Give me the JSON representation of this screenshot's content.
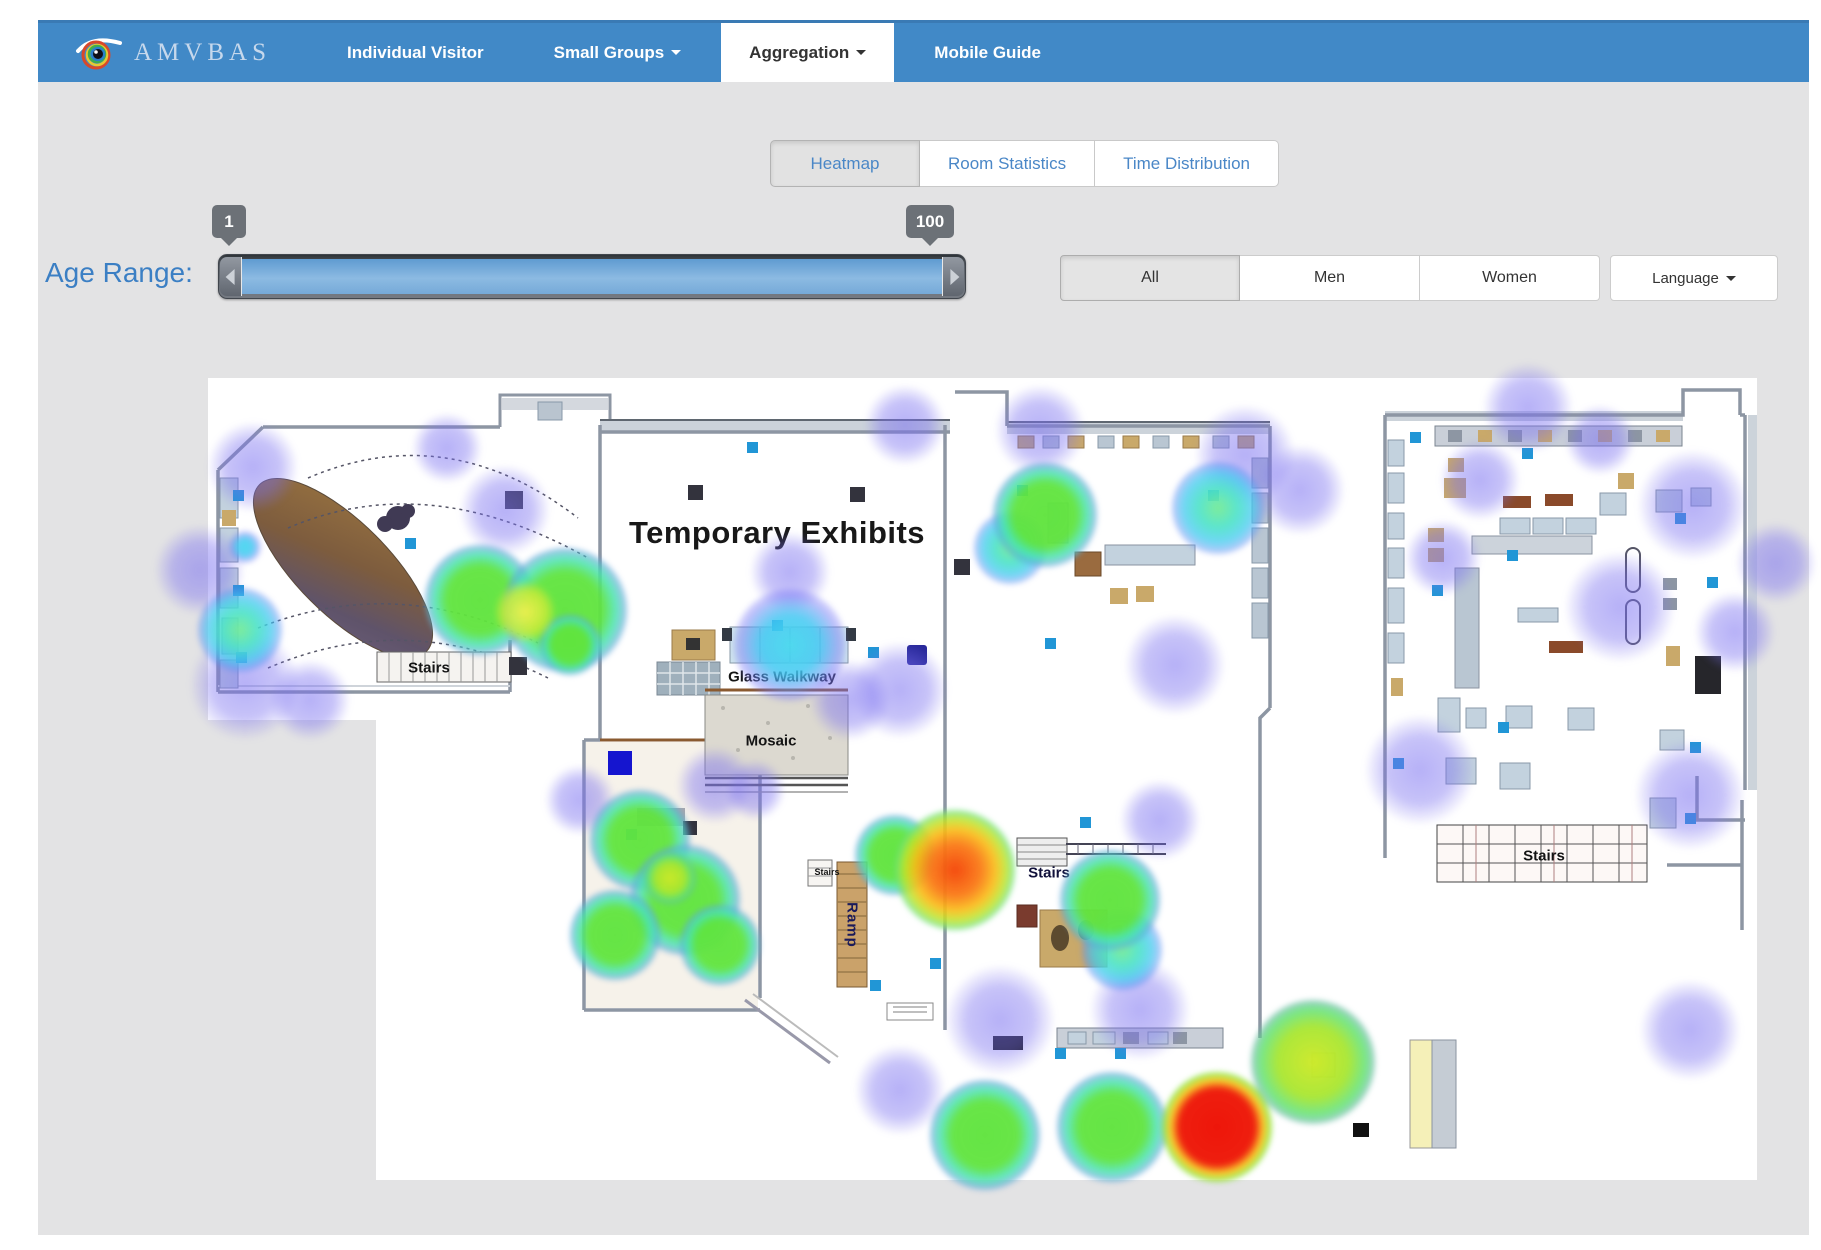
{
  "navbar": {
    "brand": "AMVBAS",
    "items": [
      {
        "label": "Individual Visitor",
        "active": false,
        "dropdown": false
      },
      {
        "label": "Small Groups",
        "active": false,
        "dropdown": true
      },
      {
        "label": "Aggregation",
        "active": true,
        "dropdown": true
      },
      {
        "label": "Mobile Guide",
        "active": false,
        "dropdown": false
      }
    ]
  },
  "view_tabs": [
    {
      "label": "Heatmap",
      "active": true
    },
    {
      "label": "Room Statistics",
      "active": false
    },
    {
      "label": "Time Distribution",
      "active": false
    }
  ],
  "filters": {
    "age_range": {
      "label": "Age Range:",
      "min": "1",
      "max": "100"
    },
    "buttons": [
      {
        "label": "All",
        "active": true
      },
      {
        "label": "Men",
        "active": false
      },
      {
        "label": "Women",
        "active": false
      },
      {
        "label": "Language",
        "active": false,
        "dropdown": true
      }
    ]
  },
  "colors": {
    "navbar_blue": "#4189c7",
    "page_gray": "#e3e3e4",
    "link_blue": "#4a87c7",
    "age_label_blue": "#3b7fc4",
    "heat_scale": {
      "low": "#7a70f0",
      "mid_low": "#48d8ee",
      "mid": "#60e43e",
      "mid_high": "#cde928",
      "high": "#fa7a16",
      "max": "#ee160a"
    }
  },
  "map": {
    "labels": [
      {
        "id": "temporary-exhibits",
        "text": "Temporary Exhibits",
        "x": 569,
        "y": 155,
        "cls": "ml-title"
      },
      {
        "id": "glass-walkway",
        "text": "Glass Walkway",
        "x": 574,
        "y": 299,
        "cls": "ml-small"
      },
      {
        "id": "mosaic",
        "text": "Mosaic",
        "x": 563,
        "y": 363,
        "cls": "ml-small"
      },
      {
        "id": "stairs-left",
        "text": "Stairs",
        "x": 221,
        "y": 290,
        "cls": "ml-small"
      },
      {
        "id": "stairs-center",
        "text": "Stairs",
        "x": 841,
        "y": 495,
        "cls": "ml-small ml-navy"
      },
      {
        "id": "stairs-right",
        "text": "Stairs",
        "x": 1336,
        "y": 478,
        "cls": "ml-small"
      },
      {
        "id": "ramp",
        "text": "Ramp",
        "x": 644,
        "y": 547,
        "cls": "ml-small ml-ramp"
      },
      {
        "id": "stairs-small",
        "text": "Stairs",
        "x": 619,
        "y": 494,
        "cls": "ml-tiny"
      }
    ],
    "heat_points": [
      {
        "x": 45,
        "y": 89,
        "r": 45,
        "c": "purple"
      },
      {
        "x": -8,
        "y": 192,
        "r": 45,
        "c": "purple"
      },
      {
        "x": 37,
        "y": 307,
        "r": 55,
        "c": "purple"
      },
      {
        "x": 102,
        "y": 322,
        "r": 40,
        "c": "purple"
      },
      {
        "x": 239,
        "y": 70,
        "r": 35,
        "c": "purple"
      },
      {
        "x": 297,
        "y": 132,
        "r": 45,
        "c": "purple"
      },
      {
        "x": 582,
        "y": 194,
        "r": 40,
        "c": "purple"
      },
      {
        "x": 642,
        "y": 322,
        "r": 40,
        "c": "purple"
      },
      {
        "x": 507,
        "y": 407,
        "r": 38,
        "c": "purple"
      },
      {
        "x": 372,
        "y": 422,
        "r": 35,
        "c": "purple"
      },
      {
        "x": 547,
        "y": 412,
        "r": 30,
        "c": "purple"
      },
      {
        "x": 697,
        "y": 47,
        "r": 40,
        "c": "purple"
      },
      {
        "x": 832,
        "y": 52,
        "r": 45,
        "c": "purple"
      },
      {
        "x": 1037,
        "y": 77,
        "r": 50,
        "c": "purple"
      },
      {
        "x": 1092,
        "y": 112,
        "r": 45,
        "c": "purple"
      },
      {
        "x": 967,
        "y": 287,
        "r": 50,
        "c": "purple"
      },
      {
        "x": 692,
        "y": 312,
        "r": 48,
        "c": "purple"
      },
      {
        "x": 952,
        "y": 442,
        "r": 40,
        "c": "purple"
      },
      {
        "x": 792,
        "y": 642,
        "r": 55,
        "c": "purple"
      },
      {
        "x": 932,
        "y": 632,
        "r": 50,
        "c": "purple"
      },
      {
        "x": 692,
        "y": 712,
        "r": 45,
        "c": "purple"
      },
      {
        "x": 1320,
        "y": 30,
        "r": 45,
        "c": "purple"
      },
      {
        "x": 1485,
        "y": 127,
        "r": 55,
        "c": "purple"
      },
      {
        "x": 1568,
        "y": 185,
        "r": 40,
        "c": "purple"
      },
      {
        "x": 1235,
        "y": 180,
        "r": 38,
        "c": "purple"
      },
      {
        "x": 1412,
        "y": 229,
        "r": 55,
        "c": "purple"
      },
      {
        "x": 1527,
        "y": 254,
        "r": 40,
        "c": "purple"
      },
      {
        "x": 1212,
        "y": 392,
        "r": 55,
        "c": "purple"
      },
      {
        "x": 1482,
        "y": 417,
        "r": 55,
        "c": "purple"
      },
      {
        "x": 1272,
        "y": 102,
        "r": 40,
        "c": "purple"
      },
      {
        "x": 1392,
        "y": 62,
        "r": 35,
        "c": "purple"
      },
      {
        "x": 1482,
        "y": 652,
        "r": 50,
        "c": "purple"
      },
      {
        "x": 37,
        "y": 169,
        "r": 16,
        "c": "cyan"
      },
      {
        "x": 582,
        "y": 267,
        "r": 56,
        "c": "cyan"
      },
      {
        "x": 32,
        "y": 252,
        "r": 42,
        "c": "teal"
      },
      {
        "x": 802,
        "y": 170,
        "r": 36,
        "c": "teal"
      },
      {
        "x": 1010,
        "y": 130,
        "r": 46,
        "c": "teal"
      },
      {
        "x": 914,
        "y": 572,
        "r": 40,
        "c": "teal"
      },
      {
        "x": 272,
        "y": 222,
        "r": 55,
        "c": "green"
      },
      {
        "x": 357,
        "y": 232,
        "r": 62,
        "c": "green"
      },
      {
        "x": 362,
        "y": 267,
        "r": 30,
        "c": "green"
      },
      {
        "x": 432,
        "y": 462,
        "r": 50,
        "c": "green"
      },
      {
        "x": 477,
        "y": 522,
        "r": 55,
        "c": "green"
      },
      {
        "x": 407,
        "y": 557,
        "r": 45,
        "c": "green"
      },
      {
        "x": 512,
        "y": 567,
        "r": 40,
        "c": "green"
      },
      {
        "x": 687,
        "y": 477,
        "r": 40,
        "c": "green"
      },
      {
        "x": 837,
        "y": 137,
        "r": 52,
        "c": "green"
      },
      {
        "x": 902,
        "y": 522,
        "r": 50,
        "c": "green"
      },
      {
        "x": 777,
        "y": 757,
        "r": 55,
        "c": "green"
      },
      {
        "x": 904,
        "y": 749,
        "r": 55,
        "c": "green"
      },
      {
        "x": 317,
        "y": 234,
        "r": 30,
        "c": "yellow"
      },
      {
        "x": 462,
        "y": 500,
        "r": 26,
        "c": "yellowgreen"
      },
      {
        "x": 1105,
        "y": 684,
        "r": 62,
        "c": "yellowgreen"
      },
      {
        "x": 747,
        "y": 492,
        "r": 60,
        "c": "orange"
      },
      {
        "x": 1009,
        "y": 749,
        "r": 55,
        "c": "red"
      }
    ],
    "sensors": [
      {
        "x": 30,
        "y": 117,
        "c": "blue"
      },
      {
        "x": 30,
        "y": 212,
        "c": "blue"
      },
      {
        "x": 33,
        "y": 279,
        "c": "blue"
      },
      {
        "x": 202,
        "y": 165,
        "c": "blue"
      },
      {
        "x": 544,
        "y": 69,
        "c": "blue"
      },
      {
        "x": 569,
        "y": 247,
        "c": "blue"
      },
      {
        "x": 665,
        "y": 274,
        "c": "blue"
      },
      {
        "x": 814,
        "y": 112,
        "c": "blue"
      },
      {
        "x": 1005,
        "y": 117,
        "c": "blue"
      },
      {
        "x": 842,
        "y": 265,
        "c": "blue"
      },
      {
        "x": 877,
        "y": 444,
        "c": "blue"
      },
      {
        "x": 727,
        "y": 585,
        "c": "blue"
      },
      {
        "x": 667,
        "y": 607,
        "c": "blue"
      },
      {
        "x": 423,
        "y": 456,
        "c": "blue"
      },
      {
        "x": 852,
        "y": 675,
        "c": "blue"
      },
      {
        "x": 912,
        "y": 675,
        "c": "blue"
      },
      {
        "x": 1207,
        "y": 59,
        "c": "blue"
      },
      {
        "x": 1319,
        "y": 75,
        "c": "blue"
      },
      {
        "x": 1304,
        "y": 177,
        "c": "blue"
      },
      {
        "x": 1472,
        "y": 140,
        "c": "blue"
      },
      {
        "x": 1504,
        "y": 204,
        "c": "blue"
      },
      {
        "x": 1229,
        "y": 212,
        "c": "blue"
      },
      {
        "x": 1295,
        "y": 349,
        "c": "blue"
      },
      {
        "x": 1190,
        "y": 385,
        "c": "blue"
      },
      {
        "x": 1487,
        "y": 369,
        "c": "blue"
      },
      {
        "x": 1482,
        "y": 440,
        "c": "blue"
      },
      {
        "x": 487,
        "y": 114,
        "c": "dark",
        "s": 15
      },
      {
        "x": 649,
        "y": 116,
        "c": "dark",
        "s": 15
      },
      {
        "x": 306,
        "y": 122,
        "c": "dark",
        "s": 18
      },
      {
        "x": 310,
        "y": 288,
        "c": "dark",
        "s": 18
      },
      {
        "x": 754,
        "y": 189,
        "c": "dark",
        "s": 16
      },
      {
        "x": 482,
        "y": 450,
        "c": "dark",
        "s": 14
      },
      {
        "x": 709,
        "y": 277,
        "c": "navy",
        "s": 20
      },
      {
        "x": 412,
        "y": 385,
        "c": "royal",
        "s": 24
      }
    ]
  }
}
